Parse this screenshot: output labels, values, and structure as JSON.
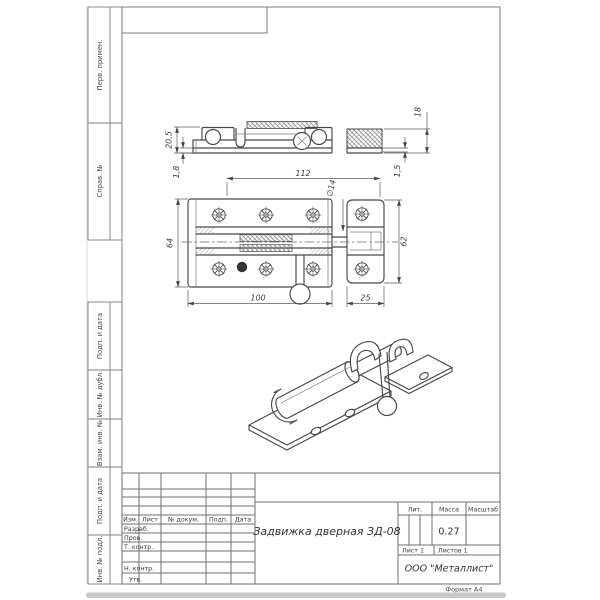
{
  "strip": {
    "boxes": [
      {
        "label": "Перв. примен."
      },
      {
        "label": "Справ. №"
      },
      {
        "label": "Подп. и дата"
      },
      {
        "label": "Инв. № дубл."
      },
      {
        "label": "Взам. инв. №"
      },
      {
        "label": "Подп. и дата"
      },
      {
        "label": "Инв. № подл."
      }
    ]
  },
  "dims": {
    "h205": "20,5",
    "t18": "1,8",
    "l112": "112",
    "dia14": "∅14",
    "h18": "18",
    "t15": "1,5",
    "h64": "64",
    "l100": "100",
    "l25": "25",
    "h62": "62"
  },
  "logo": {
    "letter": "М"
  },
  "title_block": {
    "header_cols": [
      "Изм.",
      "Лист",
      "№ докум.",
      "Подп.",
      "Дата"
    ],
    "row_labels": [
      "Разраб.",
      "Пров.",
      "Т. контр.",
      "Н. контр.",
      "Утв."
    ],
    "doc_name": "Задвижка дверная ЗД-08",
    "lit": "Лит.",
    "mass": "Масса",
    "scale": "Масштаб",
    "mass_value": "0.27",
    "sheet": "Лист 1",
    "sheets": "Листов 1",
    "company": "ООО \"Металлист\"",
    "format": "Формат А4"
  }
}
